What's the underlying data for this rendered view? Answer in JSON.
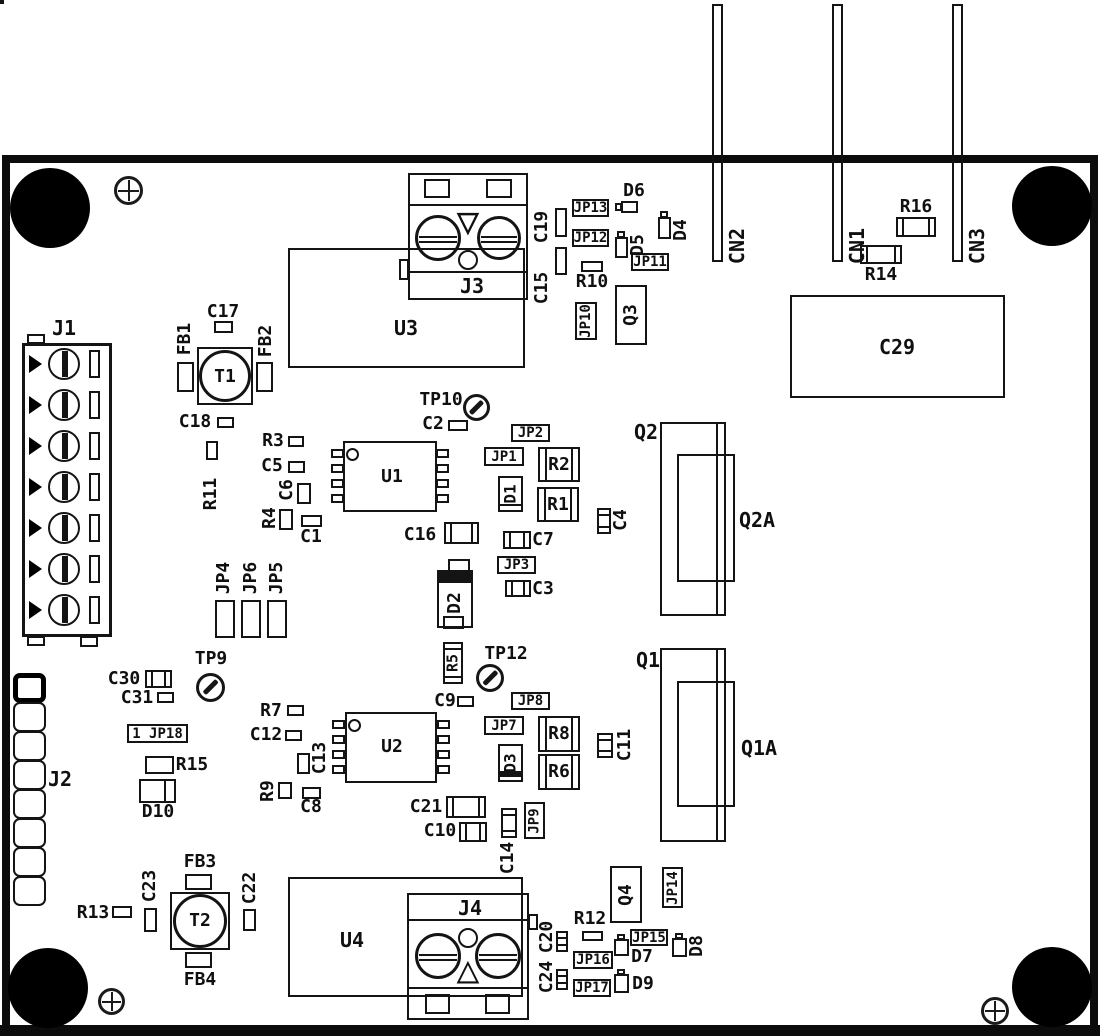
{
  "diagram": {
    "type": "pcb-component-placement-drawing"
  },
  "icons": {
    "triangle_down": "▽",
    "triangle_up": "△"
  },
  "connectors": {
    "j1": "J1",
    "j2": "J2",
    "j3": "J3",
    "j4": "J4",
    "cn1": "CN1",
    "cn2": "CN2",
    "cn3": "CN3"
  },
  "ics": {
    "u1": "U1",
    "u2": "U2",
    "u3": "U3",
    "u4": "U4"
  },
  "transformers": {
    "t1": "T1",
    "t2": "T2"
  },
  "transistors": {
    "q1": "Q1",
    "q1a": "Q1A",
    "q2": "Q2",
    "q2a": "Q2A",
    "q3": "Q3",
    "q4": "Q4"
  },
  "test_points": {
    "tp9": "TP9",
    "tp10": "TP10",
    "tp12": "TP12"
  },
  "ferrite_beads": {
    "fb1": "FB1",
    "fb2": "FB2",
    "fb3": "FB3",
    "fb4": "FB4"
  },
  "jumpers": {
    "jp1": "JP1",
    "jp2": "JP2",
    "jp3": "JP3",
    "jp4": "JP4",
    "jp5": "JP5",
    "jp6": "JP6",
    "jp7": "JP7",
    "jp8": "JP8",
    "jp9": "JP9",
    "jp10": "JP10",
    "jp11": "JP11",
    "jp12": "JP12",
    "jp13": "JP13",
    "jp14": "JP14",
    "jp15": "JP15",
    "jp16": "JP16",
    "jp17": "JP17",
    "jp18": "1 JP18"
  },
  "resistors": {
    "r1": "R1",
    "r2": "R2",
    "r3": "R3",
    "r4": "R4",
    "r5": "R5",
    "r6": "R6",
    "r7": "R7",
    "r8": "R8",
    "r9": "R9",
    "r10": "R10",
    "r11": "R11",
    "r12": "R12",
    "r13": "R13",
    "r14": "R14",
    "r15": "R15",
    "r16": "R16"
  },
  "capacitors": {
    "c1": "C1",
    "c2": "C2",
    "c3": "C3",
    "c4": "C4",
    "c5": "C5",
    "c6": "C6",
    "c7": "C7",
    "c8": "C8",
    "c9": "C9",
    "c10": "C10",
    "c11": "C11",
    "c12": "C12",
    "c13": "C13",
    "c14": "C14",
    "c15": "C15",
    "c16": "C16",
    "c17": "C17",
    "c18": "C18",
    "c19": "C19",
    "c20": "C20",
    "c21": "C21",
    "c22": "C22",
    "c23": "C23",
    "c24": "C24",
    "c29": "C29",
    "c30": "C30",
    "c31": "C31"
  },
  "diodes": {
    "d1": "D1",
    "d2": "D2",
    "d3": "D3",
    "d4": "D4",
    "d5": "D5",
    "d6": "D6",
    "d7": "D7",
    "d8": "D8",
    "d9": "D9",
    "d10": "D10"
  }
}
